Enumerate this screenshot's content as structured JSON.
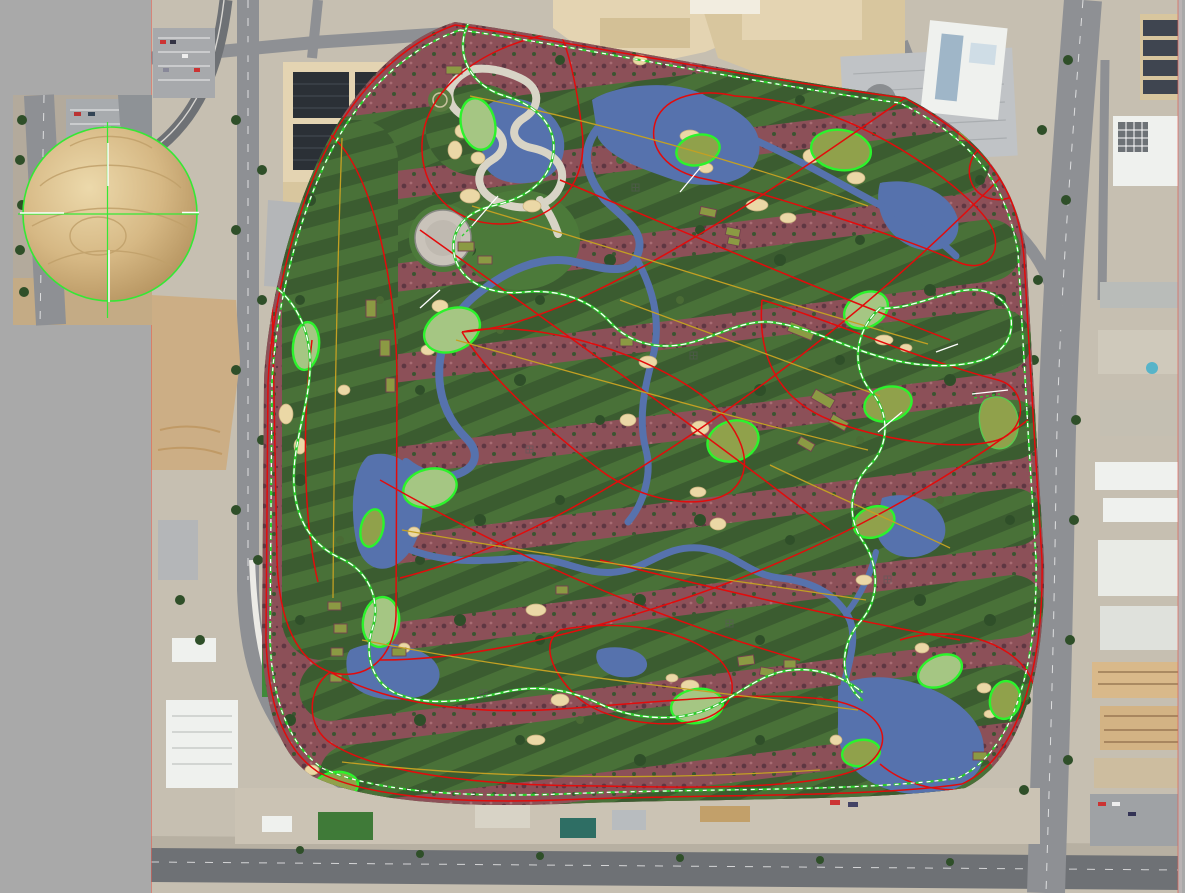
{
  "window": {
    "type": "map-canvas",
    "description": "Golf course routing/shaping plan overlaid on aerial satellite imagery, with a selected spherical dome object shown in an inset image patch with a measurement crosshair",
    "visible_text": "none"
  },
  "colors": {
    "canvas": "#a9a9a9",
    "city_ground": "#c6bfb1",
    "road": "#8e9094",
    "road_dark": "#6e7175",
    "sidewalk": "#c2bcb0",
    "building_tan": "#e4d4b2",
    "building_tan2": "#d8c69e",
    "building_gray": "#c0c3c6",
    "building_white": "#eff1ee",
    "solar_panel": "#2b3036",
    "dirt": "#ccae85",
    "course_rough": "#4e6e3c",
    "fairway": "#3b5c30",
    "fairway_stripe": "#497138",
    "desert": "#8c5058",
    "desert_shadow": "#5e3742",
    "water": "#5672ad",
    "bunker": "#ebd8a6",
    "bunker_edge": "#c7ae7c",
    "green_light": "#a5c683",
    "green_olive": "#90a14b",
    "green_outline": "#2cf32c",
    "green_soft": "#59c94f",
    "tee": "#8b9a43",
    "tee_edge": "#76414f",
    "line_red": "#e30b0b",
    "line_yellow": "#c3a023",
    "path_green": "#2ccc2c",
    "tick_white": "#ffffff",
    "concrete": "#d8d4c6",
    "tree": "#2f4f29",
    "tree_light": "#4a6b35",
    "sphere": "#d6b884",
    "sphere_hi": "#ecd9ab",
    "sphere_lo": "#b2905c",
    "crosshair": "#35e835",
    "seam": "#e06055"
  },
  "overlay_legend": [
    {
      "name": "hole-boundary-line",
      "color": "#e30b0b",
      "style": "solid curve"
    },
    {
      "name": "hole-centerline",
      "color": "#c3a023",
      "style": "solid thin"
    },
    {
      "name": "cart-path",
      "color": "#2ccc2c",
      "style": "green line with white dash overlay"
    },
    {
      "name": "course-perimeter-path",
      "color": "#2ccc2c",
      "style": "green/white dashed"
    },
    {
      "name": "putting-green-outline",
      "color": "#2cf32c",
      "style": "solid"
    },
    {
      "name": "water-hazard",
      "color": "#5672ad",
      "style": "area fill"
    },
    {
      "name": "sand-bunker",
      "color": "#ebd8a6",
      "style": "area fill"
    },
    {
      "name": "tee-box",
      "color": "#8b9a43",
      "style": "rectangle"
    },
    {
      "name": "desert-vegetation",
      "color": "#8c5058",
      "style": "area fill"
    },
    {
      "name": "measurement-crosshair",
      "color": "#35e835",
      "style": "green cross with white ticks"
    }
  ],
  "map_features": {
    "putting_greens": 18,
    "water_bodies": 8,
    "inset_object": "sand-colored dome/sphere with green selection circle and crosshair",
    "surroundings": "city blocks, resort buildings, parking garage, boulevards, monorail guideway"
  }
}
